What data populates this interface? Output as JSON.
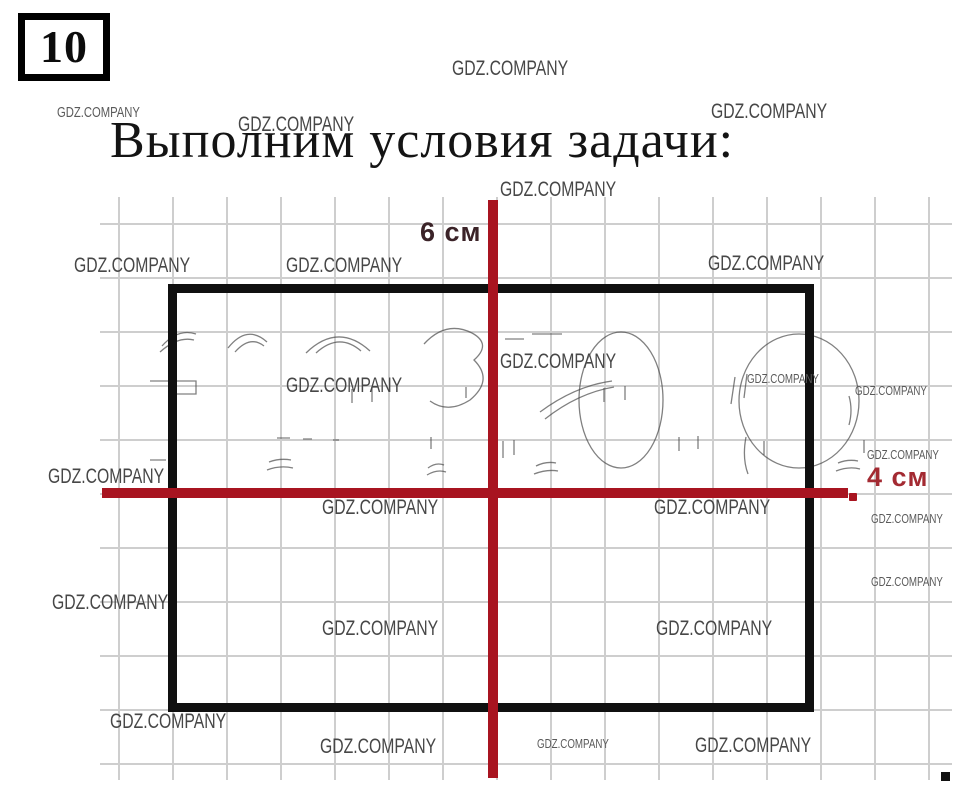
{
  "header": {
    "problem_number": "10",
    "title": "Выполним условия задачи:"
  },
  "figure": {
    "vertical_line_label": "6 см",
    "horizontal_line_label": "4 см",
    "colors": {
      "line_red": "#a81420",
      "label_red": "#a32a32",
      "label_dark": "#3b2328",
      "shape_black": "#101010",
      "grid_gray": "#c6c6c6",
      "watermark_gray": "#474747"
    }
  },
  "watermark": {
    "text": "GDZ.COMPANY",
    "instances": [
      {
        "x": 452,
        "y": 56,
        "s": 21
      },
      {
        "x": 57,
        "y": 104,
        "s": 15
      },
      {
        "x": 238,
        "y": 112,
        "s": 21
      },
      {
        "x": 711,
        "y": 99,
        "s": 21
      },
      {
        "x": 500,
        "y": 177,
        "s": 21
      },
      {
        "x": 74,
        "y": 253,
        "s": 21
      },
      {
        "x": 286,
        "y": 253,
        "s": 21
      },
      {
        "x": 708,
        "y": 251,
        "s": 21
      },
      {
        "x": 500,
        "y": 349,
        "s": 21
      },
      {
        "x": 286,
        "y": 373,
        "s": 21
      },
      {
        "x": 747,
        "y": 371,
        "s": 13
      },
      {
        "x": 855,
        "y": 383,
        "s": 13
      },
      {
        "x": 48,
        "y": 464,
        "s": 21
      },
      {
        "x": 867,
        "y": 447,
        "s": 13
      },
      {
        "x": 322,
        "y": 495,
        "s": 21
      },
      {
        "x": 654,
        "y": 495,
        "s": 21
      },
      {
        "x": 871,
        "y": 511,
        "s": 13
      },
      {
        "x": 52,
        "y": 590,
        "s": 21
      },
      {
        "x": 871,
        "y": 574,
        "s": 13
      },
      {
        "x": 322,
        "y": 616,
        "s": 21
      },
      {
        "x": 656,
        "y": 616,
        "s": 21
      },
      {
        "x": 110,
        "y": 709,
        "s": 21
      },
      {
        "x": 320,
        "y": 734,
        "s": 21
      },
      {
        "x": 537,
        "y": 736,
        "s": 13
      },
      {
        "x": 695,
        "y": 733,
        "s": 21
      }
    ]
  }
}
